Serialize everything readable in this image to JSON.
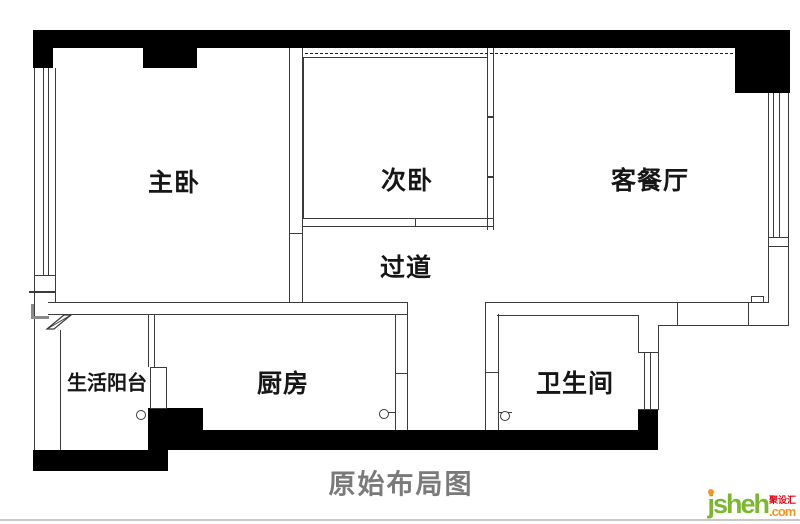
{
  "caption": "原始布局图",
  "rooms": {
    "master_bedroom": "主卧",
    "second_bedroom": "次卧",
    "living_dining": "客餐厅",
    "hallway": "过道",
    "kitchen": "厨房",
    "bathroom": "卫生间",
    "utility_balcony": "生活阳台"
  },
  "watermark": {
    "brand": "jsheh",
    "tld": ".com",
    "cn": "聚设汇"
  },
  "colors": {
    "wall_fill": "#000000",
    "line": "#3b3b3b",
    "caption_gray": "#7a7a7a",
    "logo_green": "#7cb82f",
    "logo_orange": "#f7941d",
    "logo_red": "#e60012"
  }
}
